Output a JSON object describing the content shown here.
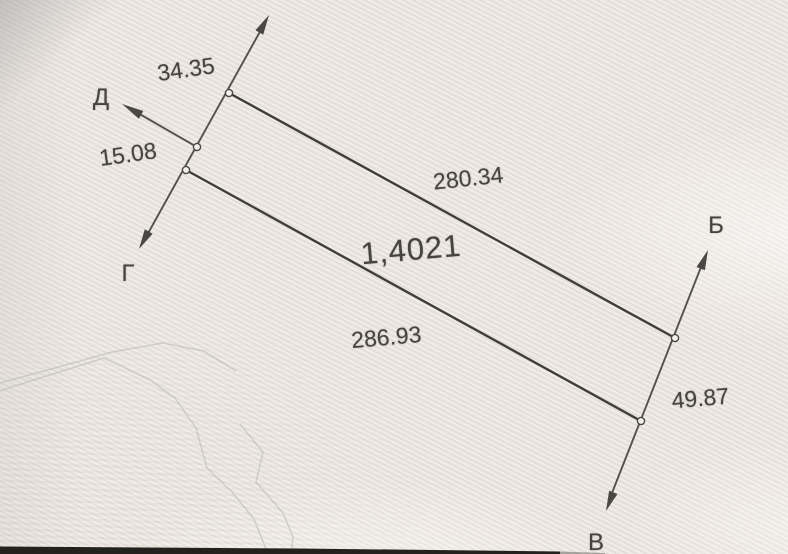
{
  "sketch": {
    "area_label": "1,4021",
    "dimensions": {
      "left_upper": "34.35",
      "left_lower": "15.08",
      "top_side": "280.34",
      "bottom_side": "286.93",
      "right_side": "49.87"
    },
    "direction_labels": {
      "top_right": "Б",
      "bottom_right": "В",
      "bottom_left": "Г",
      "upper_left": "Д"
    },
    "colors": {
      "paper": "#eae6e0",
      "ink": "#45433f",
      "contour": "#b4bab1",
      "photo_edge": "#23211d"
    }
  }
}
